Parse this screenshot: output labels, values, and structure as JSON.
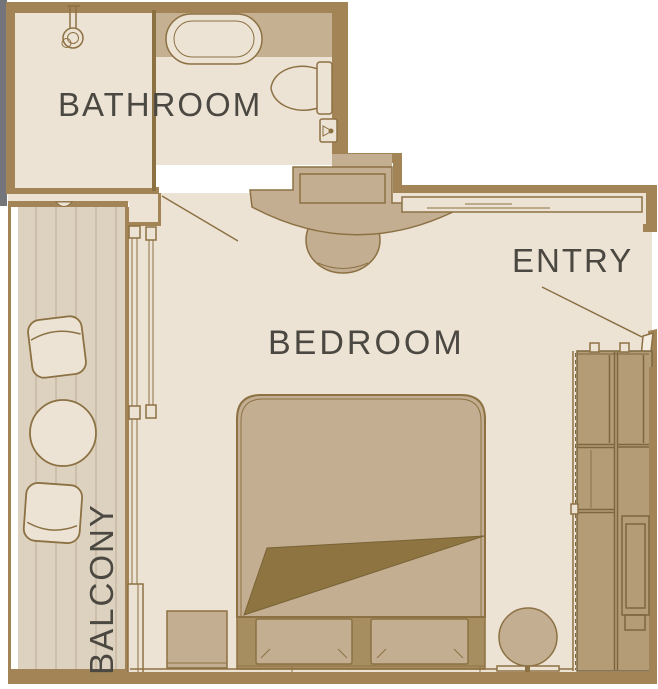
{
  "title": "Stateroom floor plan",
  "labels": {
    "bathroom": "BATHROOM",
    "bedroom": "BEDROOM",
    "entry": "ENTRY",
    "balcony": "BALCONY"
  },
  "fixtures": {
    "bathroom": [
      "shower",
      "bathtub",
      "toilet",
      "toilet-paper-holder",
      "vanity-counter",
      "vanity-stool"
    ],
    "bedroom": [
      "double-bed",
      "pillow",
      "pillow",
      "nightstand",
      "round-stool",
      "wardrobe",
      "entry-door",
      "bathroom-door",
      "sliding-balcony-door"
    ],
    "balcony": [
      "deck-chair",
      "round-table",
      "deck-chair",
      "railing"
    ]
  },
  "palette": {
    "wall": "#a28456",
    "line": "#8c7143",
    "floor": "#ece3d5",
    "furniture_tan": "#c3ae92",
    "tub_band": "#c6b092",
    "bed_base": "#a78e60",
    "fold": "#8d7440",
    "fold_line": "#7a6336",
    "closet_fill": "#b49c77",
    "closet_line": "#7d6640",
    "balcony_floor": "#ddd2bf",
    "plank_line": "#c3b49b",
    "text": "#4b4842",
    "hull_gray": "#74757a",
    "leaf_fill": "#f3ede2"
  }
}
